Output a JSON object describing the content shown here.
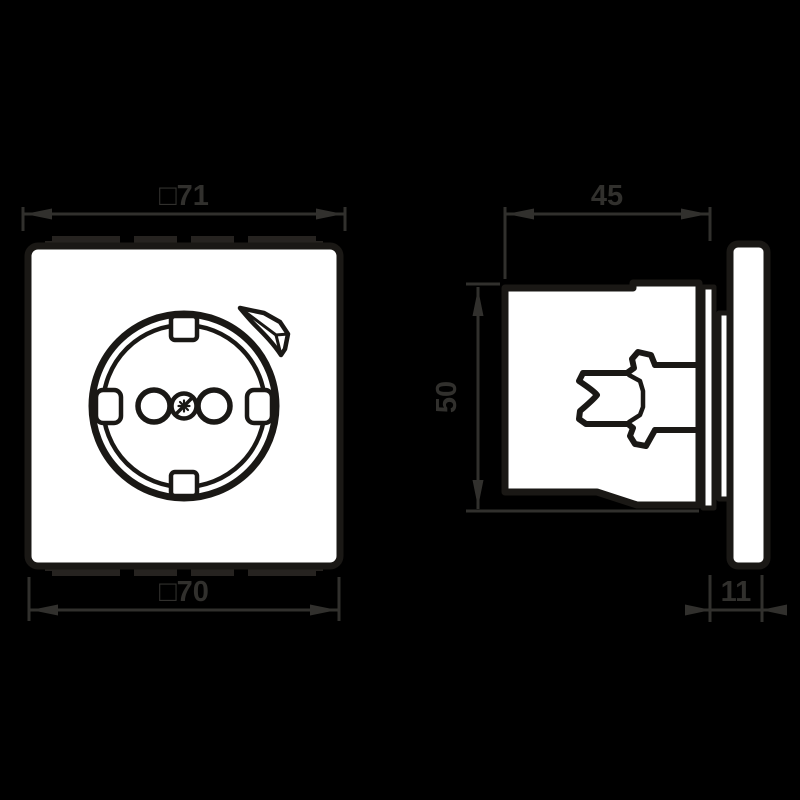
{
  "colors": {
    "background": "#000000",
    "line": "#1a1815",
    "fill": "#ffffff",
    "annotation": "#31302d",
    "tab": "#262320"
  },
  "front_view": {
    "dim_top_label": "□71",
    "dim_bottom_label": "□70"
  },
  "side_view": {
    "dim_depth_label": "45",
    "dim_height_label": "50",
    "dim_plate_label": "11"
  }
}
